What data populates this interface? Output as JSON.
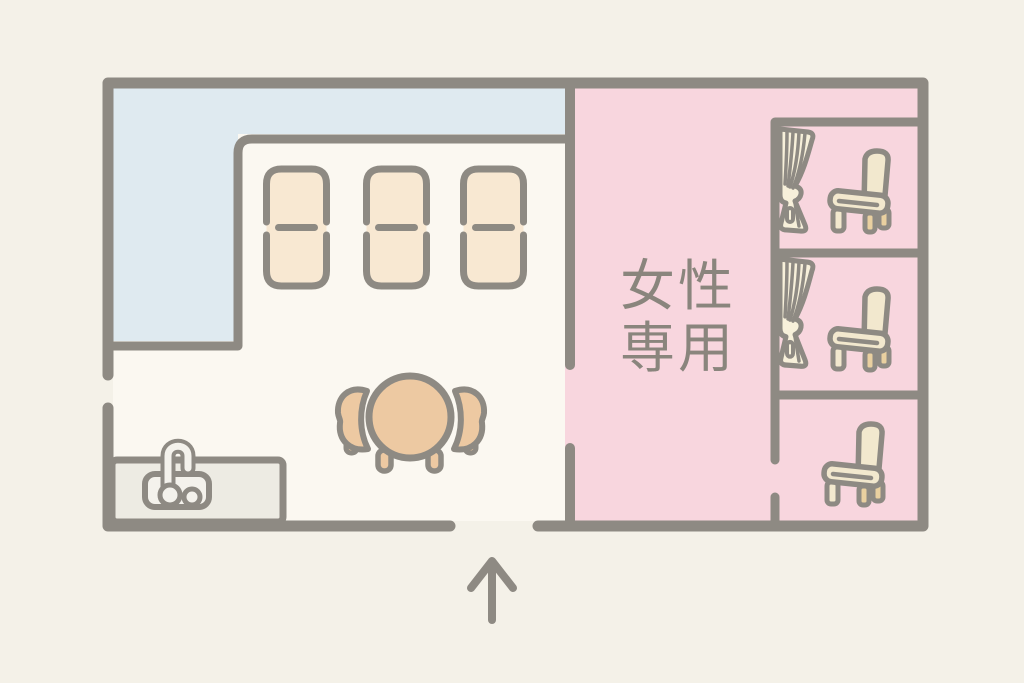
{
  "floor_plan": {
    "women_only_label": {
      "line1": "女性",
      "line2": "専用"
    },
    "entrance_arrow_icon": "up-arrow",
    "areas": {
      "floor_color": "#fbf8f1",
      "corridor_color": "#dfeaf0",
      "women_only_color": "#f8d6de",
      "background_color": "#f4f1e8"
    },
    "furniture_counts": {
      "beds": 3,
      "dining_table_chairs": 2,
      "booths": 3,
      "booth_curtains": 2,
      "booth_chairs": 3,
      "sinks": 1
    },
    "palette": {
      "wall": "#8e8a83",
      "bed_fill": "#f8e8d2",
      "table_fill": "#edc9a2",
      "chair_fill": "#f2e8ce",
      "chair_leg_fill": "#e9d0a0",
      "curtain_fill": "#f7f0da",
      "counter_fill": "#edebe3",
      "fixture_fill": "#f4f2ec",
      "label_color": "#8a857d"
    }
  }
}
